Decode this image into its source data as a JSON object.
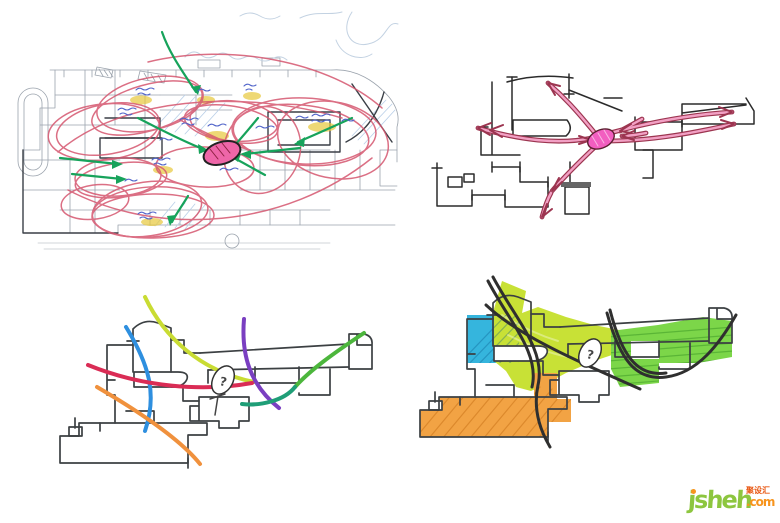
{
  "canvas": {
    "background": "#ffffff",
    "width": 780,
    "height": 523
  },
  "sketches": {
    "plan": {
      "title": "annotated-floor-plan-sketch",
      "colors": {
        "base_line": "#9ba3ad",
        "dark_line": "#3a3f46",
        "context_blue": "#c3d2e2",
        "hatch_blue": "#b9cfe8",
        "loop_red": "#d5566f",
        "arrow_green": "#17a35b",
        "note_blue": "#4f63c9",
        "highlight_yellow": "#e8c83c",
        "hub_fill": "#ee66a8",
        "hub_stroke": "#222222"
      }
    },
    "radial": {
      "title": "radial-flow-diagram-sketch",
      "colors": {
        "outline": "#2b2b2b",
        "arrow_stroke": "#9c3550",
        "arrow_fill": "#f2a0c4",
        "hub_fill": "#f25ec0",
        "hub_stroke": "#5c2030"
      }
    },
    "flows": {
      "title": "flow-curves-diagram-sketch",
      "labels": {
        "question": "?"
      },
      "colors": {
        "outline": "#3c4043",
        "chartreuse": "#c9dc33",
        "blue": "#2e8fdf",
        "crimson": "#da2c55",
        "orange": "#f0913d",
        "purple": "#7a3fc1",
        "green": "#4cb63c",
        "teal": "#1f9e77"
      }
    },
    "zones": {
      "title": "color-zoning-diagram-sketch",
      "labels": {
        "question": "?"
      },
      "colors": {
        "outline": "#3a3a3a",
        "curve": "#2f2f2f",
        "cyan": "#35b5dd",
        "chartreuse": "#c8e136",
        "green": "#7cd649",
        "orange": "#f2a344"
      }
    }
  },
  "watermark": {
    "logo": "jsheh",
    "suffix": ".com",
    "badge": "聚设汇",
    "colors": {
      "logo_green": "#8dc63f",
      "suffix_orange": "#f7941d",
      "badge_red": "#e8550f"
    }
  }
}
